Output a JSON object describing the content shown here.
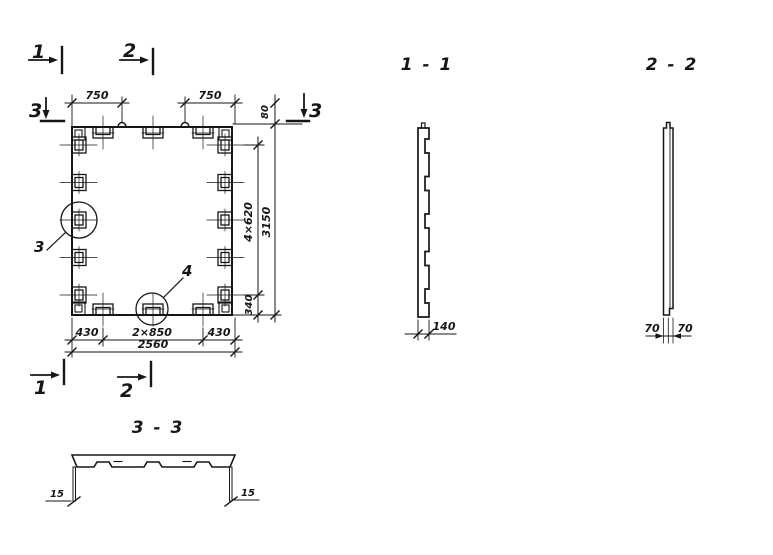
{
  "drawing": {
    "background": "#ffffff",
    "line_color": "#161616",
    "plan": {
      "markers": {
        "cut_1": "1",
        "cut_2": "2",
        "cut_3": "3"
      },
      "details": {
        "circle_3": "3",
        "circle_4": "4"
      },
      "dims": {
        "top_left": "750",
        "top_right": "750",
        "edge_top": "80",
        "side_spacing": "4×620",
        "edge_bottom": "340",
        "height_total": "3150",
        "bottom_left": "430",
        "bottom_center": "2×850",
        "bottom_right": "430",
        "width_total": "2560"
      }
    },
    "sections": {
      "s11": {
        "title": "1 - 1",
        "thickness": "140"
      },
      "s22": {
        "title": "2 - 2",
        "left": "70",
        "right": "70"
      },
      "s33": {
        "title": "3 - 3",
        "left": "15",
        "right": "15"
      }
    }
  }
}
